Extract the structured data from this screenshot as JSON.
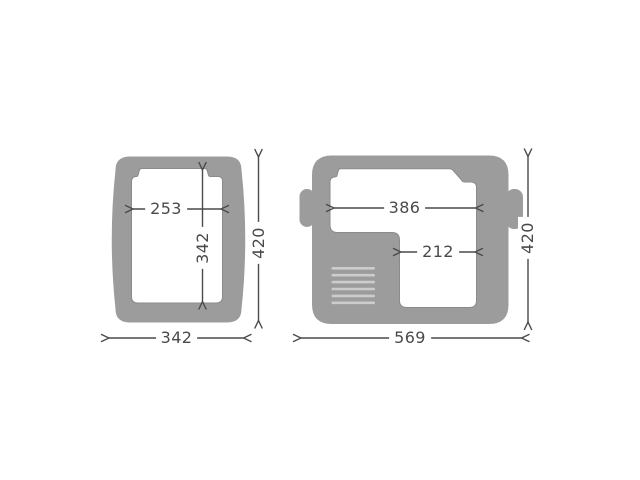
{
  "colors": {
    "page_bg": "#ffffff",
    "body_gray": "#9c9c9c",
    "cavity_fill": "#ffffff",
    "cavity_edge": "#8b8b8b",
    "vent_stripe": "#cccccc",
    "dimension_line": "#4a4a4a",
    "dimension_text": "#4a4a4a"
  },
  "views": {
    "compact": {
      "cavity_width": "253",
      "cavity_depth": "342",
      "overall_depth": "420",
      "overall_width": "342"
    },
    "wide": {
      "cavity_width_upper": "386",
      "cavity_width_lower": "212",
      "overall_depth": "420",
      "overall_width": "569"
    }
  }
}
